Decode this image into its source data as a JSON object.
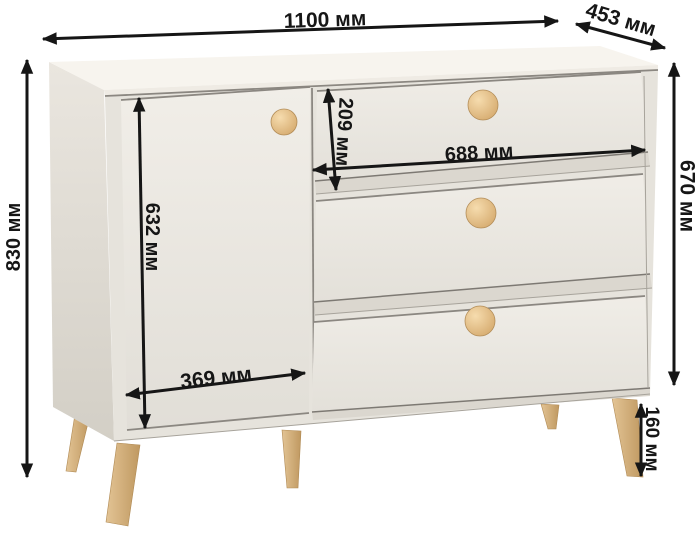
{
  "dimensions": {
    "total_width": "1100 мм",
    "depth": "453 мм",
    "total_height": "830 мм",
    "door_height": "632 мм",
    "top_drawer_height": "209 мм",
    "drawer_width": "688 мм",
    "body_height": "670 мм",
    "door_width": "369 мм",
    "leg_height": "160 мм"
  },
  "colors": {
    "background": "#ffffff",
    "dimension_ink": "#161616",
    "cabinet_top": "#f7f4ee",
    "cabinet_front_frame": "#e6e3dc",
    "cabinet_side_dark": "#d3cfc6",
    "panel_light": "#f0ede7",
    "drawer_underside": "#dbd7cf",
    "wood_leg": "#d5b383",
    "wood_knob": "#e6c28c"
  }
}
